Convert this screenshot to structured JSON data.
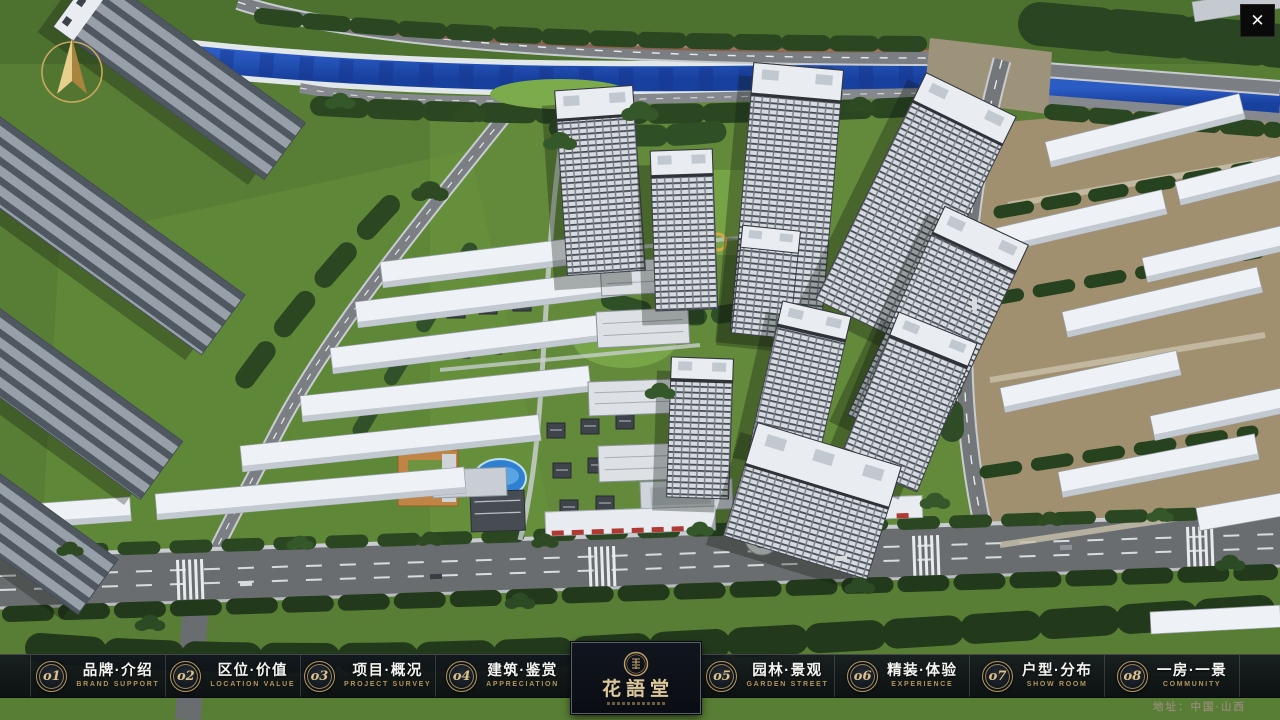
{
  "app": {
    "close_label": "✕",
    "address": "地址：中国·山西"
  },
  "nav": {
    "items": [
      {
        "num": "o1",
        "zh": "品牌·介绍",
        "en": "BRAND SUPPORT"
      },
      {
        "num": "o2",
        "zh": "区位·价值",
        "en": "LOCATION VALUE"
      },
      {
        "num": "o3",
        "zh": "项目·概况",
        "en": "PROJECT SURVEY"
      },
      {
        "num": "o4",
        "zh": "建筑·鉴赏",
        "en": "APPRECIATION"
      },
      {
        "num": "o5",
        "zh": "园林·景观",
        "en": "GARDEN STREET"
      },
      {
        "num": "o6",
        "zh": "精装·体验",
        "en": "EXPERIENCE"
      },
      {
        "num": "o7",
        "zh": "户型·分布",
        "en": "SHOW ROOM"
      },
      {
        "num": "o8",
        "zh": "一房·一景",
        "en": "COMMUNITY"
      }
    ],
    "logo": {
      "title": "花語堂"
    }
  },
  "colors": {
    "accent_gold": "#c5a45f",
    "bar_navy": "#10141c",
    "river_blue": "#2050b0",
    "grass_green": "#5c8036",
    "text_white": "#f4f4f1"
  }
}
